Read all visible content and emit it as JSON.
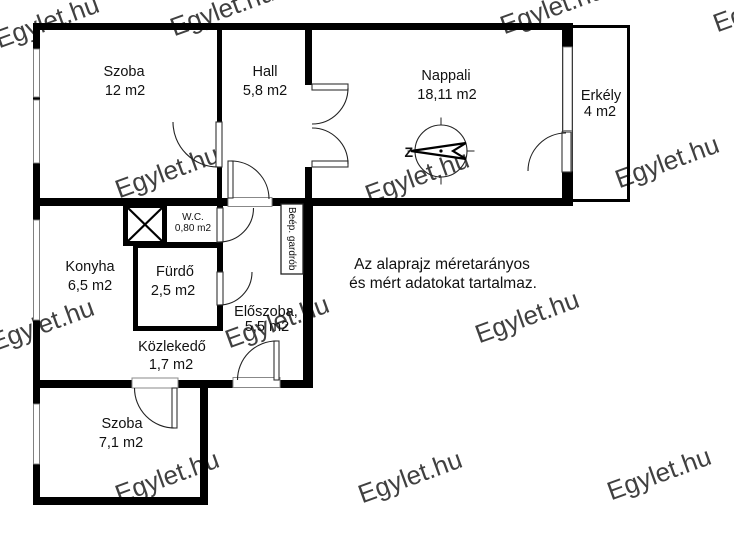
{
  "rooms": {
    "szoba12": {
      "name": "Szoba",
      "area": "12 m2"
    },
    "hall": {
      "name": "Hall",
      "area": "5,8 m2"
    },
    "nappali": {
      "name": "Nappali",
      "area": "18,11 m2"
    },
    "erkely": {
      "name": "Erkély",
      "area": "4 m2"
    },
    "konyha": {
      "name": "Konyha",
      "area": "6,5 m2"
    },
    "wc": {
      "name": "W.C.",
      "area": "0,80 m2"
    },
    "furdo": {
      "name": "Fürdő",
      "area": "2,5 m2"
    },
    "eloszoba": {
      "name": "Előszoba,",
      "area": "5,5 m2"
    },
    "kozlekedo": {
      "name": "Közlekedő",
      "area": "1,7 m2"
    },
    "gardrob": {
      "name": "Beép. gardrób"
    },
    "szoba71": {
      "name": "Szoba",
      "area": "7,1 m2"
    }
  },
  "note": {
    "line1": "Az alaprajz méretarányos",
    "line2": "és mért adatokat tartalmaz."
  },
  "compass": {
    "label": "Z"
  },
  "watermark": {
    "text": "Egylet.hu",
    "color": "#c6c6c6",
    "positions": [
      [
        50,
        30
      ],
      [
        225,
        18
      ],
      [
        555,
        16
      ],
      [
        768,
        14
      ],
      [
        170,
        180
      ],
      [
        420,
        185
      ],
      [
        670,
        170
      ],
      [
        45,
        333
      ],
      [
        280,
        330
      ],
      [
        530,
        325
      ],
      [
        170,
        485
      ],
      [
        413,
        485
      ],
      [
        662,
        482
      ]
    ]
  },
  "colors": {
    "wall": "#000000",
    "door_line": "#222222",
    "window_stroke": "#808080"
  }
}
